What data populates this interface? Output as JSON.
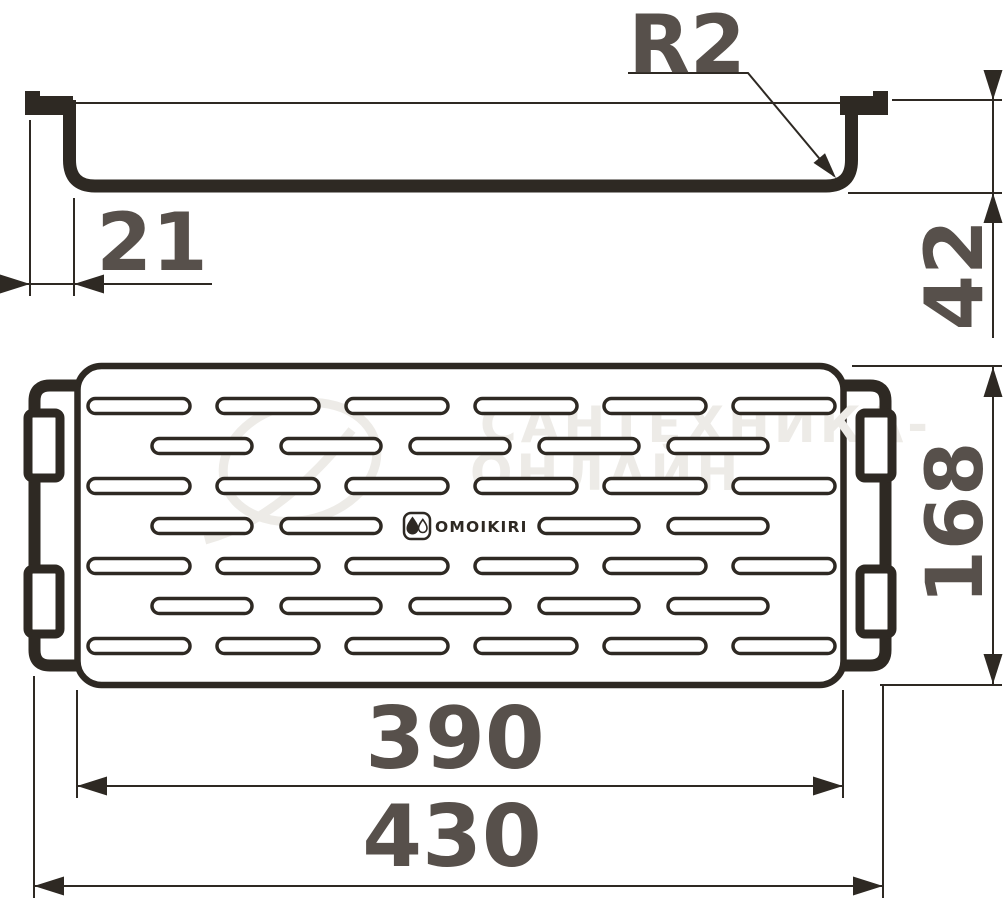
{
  "brand": {
    "name": "OMOIKIRI"
  },
  "dimensions": {
    "corner_radius": {
      "label": "R2"
    },
    "hook_offset": {
      "label": "21"
    },
    "profile_height": {
      "label": "42"
    },
    "tray_depth": {
      "label": "168"
    },
    "tray_width": {
      "label": "390"
    },
    "overall_width": {
      "label": "430"
    }
  },
  "watermark": {
    "line1": "САНТЕХНИКА-",
    "line2": "ОНЛАЙН"
  },
  "colors": {
    "ink": "#2e2923",
    "dim_text": "#57504b",
    "watermark": "#edebe7",
    "paper": "#ffffff"
  },
  "perforation": {
    "slot_height": 15,
    "rows": [
      {
        "cy": 406,
        "kind": "wide"
      },
      {
        "cy": 446,
        "kind": "narrow"
      },
      {
        "cy": 486,
        "kind": "wide"
      },
      {
        "cy": 526,
        "kind": "logo"
      },
      {
        "cy": 566,
        "kind": "wide"
      },
      {
        "cy": 606,
        "kind": "narrow"
      },
      {
        "cy": 646,
        "kind": "wide"
      }
    ],
    "wide": {
      "starts": [
        88,
        217,
        346,
        475,
        604,
        733
      ],
      "width": 102
    },
    "narrow": {
      "starts": [
        152,
        281,
        410,
        539,
        668
      ],
      "width": 100
    },
    "logo_slot_index": 2
  }
}
